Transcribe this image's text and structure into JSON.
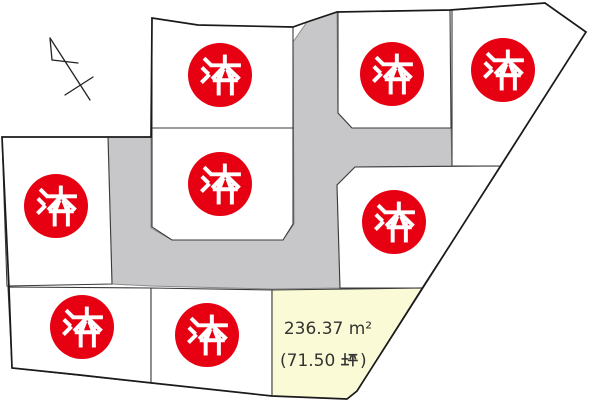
{
  "map_canvas": {
    "width": 600,
    "height": 404,
    "background": "#ffffff",
    "outline_color": "#1a1a1a"
  },
  "north_arrow": {
    "icon": "north-arrow"
  },
  "road": {
    "fill": "#c7c7c9"
  },
  "stamps": {
    "label": "済",
    "count": 8,
    "color": "#e60012",
    "text_color": "#ffffff"
  },
  "available_lot": {
    "fill_color": "#fbfad6",
    "area_sqm": "236.37 ㎡",
    "area_tsubo": "(71.50 坪)",
    "text_color": "#333333",
    "render": {
      "line1": "236.37 m²",
      "tsubo_prefix": "(71.50",
      "tsubo_unit": "坪",
      "tsubo_suffix": ")"
    }
  }
}
